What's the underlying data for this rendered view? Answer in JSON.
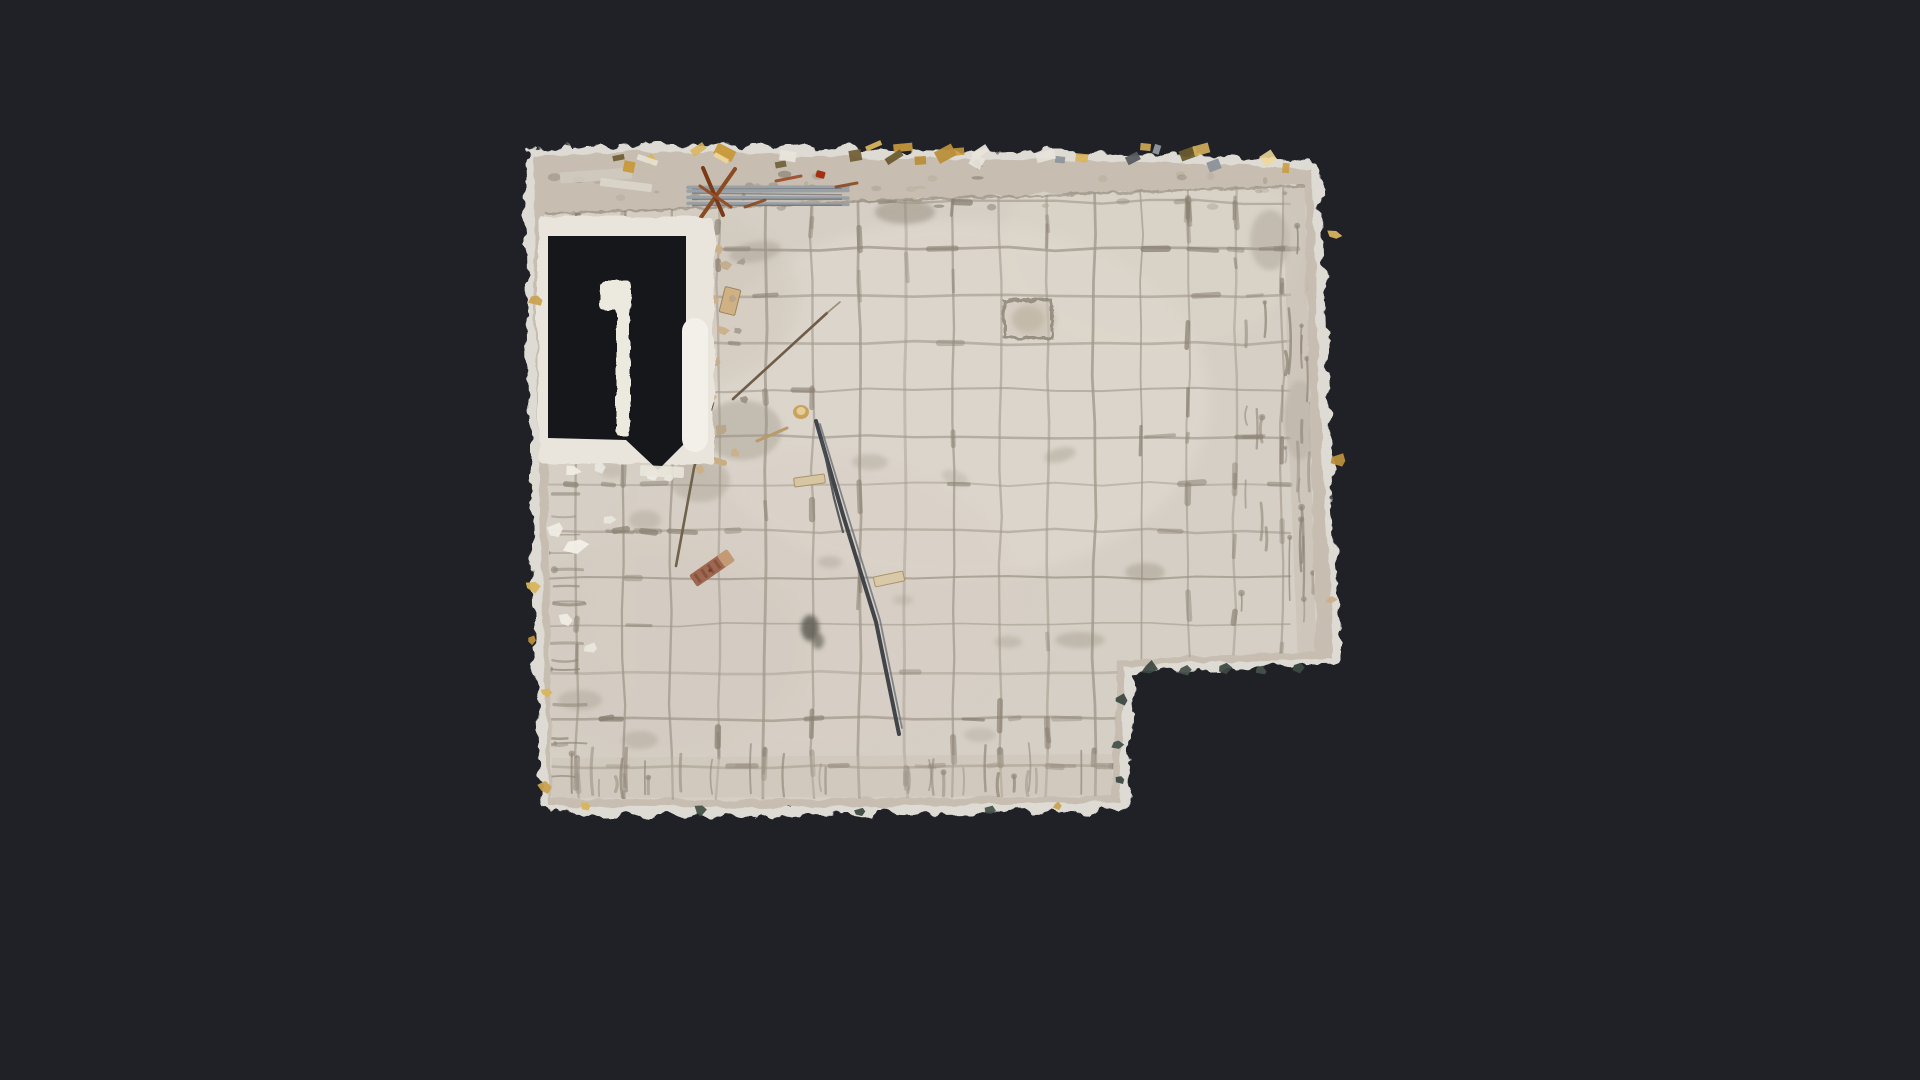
{
  "meta": {
    "view_name": "floor-plan-top-down-scan",
    "subject": "gutted room with beige tiled floor, doorway opening at top-left, notch cut-out at bottom-right, construction debris"
  },
  "scene": {
    "colors": {
      "background": "#1f2126",
      "fringe": "#e9e6df",
      "wall": "#c7beb1",
      "tile": "#d6cfc5",
      "grout": "#a1988b",
      "grout_dark": "#8a8173",
      "void": "#16171a",
      "frame": "#e9e5dc",
      "pill": "#f3f0e9",
      "pillar": "#eceade",
      "metal": "#99a0a6",
      "rod": "#41454a",
      "rust": "#8a4a22",
      "gold": "#d9b45c",
      "green_bit": "#3c4a42"
    },
    "outline": [
      [
        533,
        157
      ],
      [
        640,
        151
      ],
      [
        900,
        158
      ],
      [
        1130,
        161
      ],
      [
        1312,
        169
      ],
      [
        1319,
        400
      ],
      [
        1333,
        658
      ],
      [
        1124,
        666
      ],
      [
        1120,
        802
      ],
      [
        760,
        808
      ],
      [
        549,
        806
      ],
      [
        543,
        620
      ],
      [
        537,
        400
      ]
    ],
    "tile_poly": [
      [
        545,
        214
      ],
      [
        900,
        200
      ],
      [
        1305,
        186
      ],
      [
        1310,
        420
      ],
      [
        1316,
        652
      ],
      [
        1118,
        660
      ],
      [
        1112,
        796
      ],
      [
        700,
        800
      ],
      [
        552,
        798
      ]
    ],
    "grid": {
      "x0": 530,
      "dx": 47,
      "nx": 18,
      "y0": 202,
      "dy": 47,
      "ny": 13,
      "top": 188,
      "bottom": 802,
      "left": 538,
      "right": 1328
    },
    "door": {
      "frame": {
        "x": 538,
        "y": 216,
        "w": 176,
        "h": 248
      },
      "void_pts": [
        [
          548,
          236
        ],
        [
          686,
          236
        ],
        [
          686,
          442
        ],
        [
          658,
          470
        ],
        [
          626,
          440
        ],
        [
          548,
          438
        ]
      ],
      "pillar_cap": {
        "x": 600,
        "y": 281,
        "w": 31,
        "h": 29
      },
      "pillar_bar": {
        "x": 616,
        "y": 304,
        "w": 14,
        "h": 132
      },
      "pill": {
        "x": 682,
        "y": 318,
        "w": 26,
        "h": 134,
        "r": 13
      },
      "sill": {
        "x": 640,
        "y": 466,
        "w": 44,
        "h": 11,
        "rot": 3
      }
    },
    "right_band": [
      [
        1284,
        186
      ],
      [
        1312,
        169
      ],
      [
        1319,
        400
      ],
      [
        1333,
        658
      ],
      [
        1298,
        660
      ],
      [
        1288,
        420
      ]
    ],
    "bottom_band": [
      [
        552,
        758
      ],
      [
        1112,
        754
      ],
      [
        1112,
        796
      ],
      [
        552,
        798
      ]
    ],
    "tints": [
      {
        "x": 950,
        "y": 400,
        "rx": 260,
        "ry": 180,
        "c": "#e3dcd2",
        "o": 0.5
      },
      {
        "x": 800,
        "y": 600,
        "rx": 220,
        "ry": 150,
        "c": "#d9cfc6",
        "o": 0.4
      },
      {
        "x": 680,
        "y": 300,
        "rx": 120,
        "ry": 90,
        "c": "#cfc6b9",
        "o": 0.4
      },
      {
        "x": 1150,
        "y": 250,
        "rx": 150,
        "ry": 100,
        "c": "#ded7cb",
        "o": 0.45
      },
      {
        "x": 650,
        "y": 650,
        "rx": 160,
        "ry": 110,
        "c": "#d2c9be",
        "o": 0.4
      }
    ],
    "stains": [
      {
        "x": 755,
        "y": 252,
        "rx": 26,
        "ry": 10,
        "rot": -10,
        "c": "#9a9184",
        "o": 0.35
      },
      {
        "x": 905,
        "y": 212,
        "rx": 30,
        "ry": 12,
        "rot": 0,
        "c": "#8f8677",
        "o": 0.45
      },
      {
        "x": 1035,
        "y": 320,
        "rx": 22,
        "ry": 18,
        "rot": 0,
        "c": "#b3a996",
        "o": 0.3
      },
      {
        "x": 870,
        "y": 462,
        "rx": 18,
        "ry": 8,
        "rot": 0,
        "c": "#9a9184",
        "o": 0.3
      },
      {
        "x": 955,
        "y": 478,
        "rx": 14,
        "ry": 7,
        "rot": 20,
        "c": "#9a9184",
        "o": 0.25
      },
      {
        "x": 1145,
        "y": 572,
        "rx": 20,
        "ry": 9,
        "rot": 0,
        "c": "#8f8677",
        "o": 0.35
      },
      {
        "x": 1060,
        "y": 455,
        "rx": 16,
        "ry": 7,
        "rot": -15,
        "c": "#8f8677",
        "o": 0.3
      },
      {
        "x": 830,
        "y": 562,
        "rx": 12,
        "ry": 6,
        "rot": 0,
        "c": "#9a9184",
        "o": 0.3
      },
      {
        "x": 903,
        "y": 600,
        "rx": 10,
        "ry": 5,
        "rot": 0,
        "c": "#9a9184",
        "o": 0.25
      },
      {
        "x": 1008,
        "y": 642,
        "rx": 14,
        "ry": 6,
        "rot": 0,
        "c": "#9a9184",
        "o": 0.3
      },
      {
        "x": 742,
        "y": 430,
        "rx": 40,
        "ry": 30,
        "rot": 0,
        "c": "#97907f",
        "o": 0.35
      },
      {
        "x": 700,
        "y": 480,
        "rx": 30,
        "ry": 22,
        "rot": 0,
        "c": "#97907f",
        "o": 0.3
      },
      {
        "x": 645,
        "y": 520,
        "rx": 16,
        "ry": 10,
        "rot": 0,
        "c": "#9a9184",
        "o": 0.3
      },
      {
        "x": 612,
        "y": 470,
        "rx": 12,
        "ry": 8,
        "rot": 0,
        "c": "#a89d8c",
        "o": 0.3
      },
      {
        "x": 580,
        "y": 700,
        "rx": 22,
        "ry": 10,
        "rot": 0,
        "c": "#9a9184",
        "o": 0.3
      },
      {
        "x": 640,
        "y": 740,
        "rx": 18,
        "ry": 9,
        "rot": 0,
        "c": "#9a9184",
        "o": 0.3
      },
      {
        "x": 980,
        "y": 735,
        "rx": 16,
        "ry": 7,
        "rot": 0,
        "c": "#9a9184",
        "o": 0.25
      },
      {
        "x": 1080,
        "y": 640,
        "rx": 25,
        "ry": 8,
        "rot": 0,
        "c": "#8f8677",
        "o": 0.3
      },
      {
        "x": 1270,
        "y": 240,
        "rx": 20,
        "ry": 30,
        "rot": 0,
        "c": "#9a9184",
        "o": 0.35
      },
      {
        "x": 1300,
        "y": 420,
        "rx": 16,
        "ry": 40,
        "rot": 0,
        "c": "#9a9184",
        "o": 0.4
      },
      {
        "x": 810,
        "y": 628,
        "rx": 9,
        "ry": 13,
        "rot": 0,
        "c": "#5f5d55",
        "o": 0.85
      },
      {
        "x": 818,
        "y": 641,
        "rx": 6,
        "ry": 8,
        "rot": 0,
        "c": "#6b685e",
        "o": 0.7
      }
    ],
    "emphasis_zones": [
      {
        "x": 545,
        "y": 192,
        "w": 770,
        "h": 70,
        "n": 30
      },
      {
        "x": 560,
        "y": 690,
        "w": 556,
        "h": 104,
        "n": 34
      },
      {
        "x": 1150,
        "y": 190,
        "w": 166,
        "h": 462,
        "n": 26
      },
      {
        "x": 545,
        "y": 450,
        "w": 130,
        "h": 348,
        "n": 18
      },
      {
        "x": 700,
        "y": 250,
        "w": 600,
        "h": 430,
        "n": 22
      }
    ],
    "drip_clusters": [
      {
        "kind": "down",
        "x0": 1288,
        "x1": 1326,
        "y0": 200,
        "y1": 600,
        "n": 24,
        "l0": 18,
        "l1": 70,
        "c": "#8b8275"
      },
      {
        "kind": "down",
        "x0": 1240,
        "x1": 1286,
        "y0": 300,
        "y1": 600,
        "n": 12,
        "l0": 12,
        "l1": 40,
        "c": "#8f8678"
      },
      {
        "kind": "up",
        "x0": 565,
        "x1": 1110,
        "y0": 790,
        "y1": 798,
        "n": 26,
        "l0": 14,
        "l1": 52,
        "c": "#8f8677"
      },
      {
        "kind": "right",
        "x0": 548,
        "x1": 556,
        "y0": 470,
        "y1": 795,
        "n": 16,
        "l0": 10,
        "l1": 34,
        "c": "#8f8677"
      }
    ],
    "top_mottle": {
      "x0": 552,
      "x1": 1300,
      "y0": 174,
      "y1": 208,
      "n": 46
    },
    "gold_top": {
      "x0": 545,
      "x1": 1305,
      "y0": 142,
      "y1": 164,
      "n": 30,
      "palette": [
        "#d9b45c",
        "#c89a3e",
        "#efd79a",
        "#8f959c",
        "#565b60",
        "#e8e4da",
        "#b98f3a",
        "#6b5a2e"
      ]
    },
    "items": [
      {
        "t": "rect",
        "x": 560,
        "y": 170,
        "w": 72,
        "h": 11,
        "rot": -4,
        "c": "#cfc9be",
        "o": 0.9
      },
      {
        "t": "rect",
        "x": 600,
        "y": 181,
        "w": 52,
        "h": 8,
        "rot": 7,
        "c": "#ddd8cd",
        "o": 0.85
      },
      {
        "t": "pipes",
        "x": 688,
        "y": 186,
        "len": 160,
        "n": 4,
        "gap": 6,
        "c": "#99a0a6",
        "c2": "#5f646a"
      },
      {
        "t": "line",
        "x1": 690,
        "y1": 233,
        "x2": 735,
        "y2": 169,
        "w": 4,
        "c": "#8a4a22",
        "o": 1
      },
      {
        "t": "line",
        "x1": 703,
        "y1": 168,
        "x2": 723,
        "y2": 215,
        "w": 4,
        "c": "#7a3a18",
        "o": 1
      },
      {
        "t": "line",
        "x1": 700,
        "y1": 186,
        "x2": 731,
        "y2": 207,
        "w": 3,
        "c": "#93502a",
        "o": 1
      },
      {
        "t": "line",
        "x1": 745,
        "y1": 207,
        "x2": 765,
        "y2": 200,
        "w": 3,
        "c": "#8a4a22",
        "o": 0.9
      },
      {
        "t": "line",
        "x1": 776,
        "y1": 181,
        "x2": 801,
        "y2": 176,
        "w": 3,
        "c": "#9c4a26",
        "o": 0.9
      },
      {
        "t": "line",
        "x1": 836,
        "y1": 187,
        "x2": 857,
        "y2": 183,
        "w": 3,
        "c": "#8a4a22",
        "o": 0.9
      },
      {
        "t": "rect",
        "x": 816,
        "y": 171,
        "w": 9,
        "h": 7,
        "rot": 15,
        "c": "#a33012",
        "o": 1
      },
      {
        "t": "path",
        "pts": [
          [
            816,
            421
          ],
          [
            843,
            515
          ],
          [
            876,
            622
          ],
          [
            899,
            734
          ]
        ],
        "w": 4,
        "c": "#41454a",
        "o": 1
      },
      {
        "t": "path",
        "pts": [
          [
            820,
            424
          ],
          [
            848,
            516
          ],
          [
            880,
            620
          ],
          [
            902,
            728
          ]
        ],
        "w": 1.8,
        "c": "#767b81",
        "o": 0.9
      },
      {
        "t": "path",
        "pts": [
          [
            822,
            440
          ],
          [
            834,
            498
          ],
          [
            843,
            532
          ]
        ],
        "w": 2.2,
        "c": "#4a4e52",
        "o": 0.9
      },
      {
        "t": "line",
        "x1": 733,
        "y1": 399,
        "x2": 827,
        "y2": 313,
        "w": 2.6,
        "c": "#6e5d48",
        "o": 1
      },
      {
        "t": "line",
        "x1": 827,
        "y1": 313,
        "x2": 840,
        "y2": 302,
        "w": 1.6,
        "c": "#8a7a60",
        "o": 0.8
      },
      {
        "t": "path",
        "pts": [
          [
            713,
            403
          ],
          [
            694,
            468
          ],
          [
            676,
            566
          ]
        ],
        "w": 2.6,
        "c": "#71624c",
        "o": 1
      },
      {
        "t": "line",
        "x1": 757,
        "y1": 441,
        "x2": 787,
        "y2": 428,
        "w": 3,
        "c": "#b99a6a",
        "o": 1
      },
      {
        "t": "line",
        "x1": 700,
        "y1": 456,
        "x2": 724,
        "y2": 463,
        "w": 6,
        "c": "#c9ae82",
        "o": 1
      },
      {
        "t": "rect",
        "x": 722,
        "y": 288,
        "w": 16,
        "h": 26,
        "rot": 14,
        "c": "#cfb184",
        "o": 1,
        "s": "#9a855e",
        "sw": 1
      },
      {
        "t": "brush",
        "x": 712,
        "y": 568,
        "w": 46,
        "h": 14,
        "rot": -35
      },
      {
        "t": "ell",
        "x": 801,
        "y": 412,
        "rx": 8,
        "ry": 7,
        "c": "#c9a25f",
        "o": 1
      },
      {
        "t": "ell",
        "x": 801,
        "y": 411,
        "rx": 4.5,
        "ry": 4,
        "c": "#e6cd96",
        "o": 1
      },
      {
        "t": "rect",
        "x": 794,
        "y": 476,
        "w": 31,
        "h": 9,
        "rot": -8,
        "c": "#d7c6a4",
        "o": 1,
        "s": "#a89468",
        "sw": 1
      },
      {
        "t": "rect",
        "x": 874,
        "y": 574,
        "w": 30,
        "h": 10,
        "rot": -12,
        "c": "#d9c9a8",
        "o": 1,
        "s": "#a89468",
        "sw": 1
      },
      {
        "t": "sqout",
        "x": 1004,
        "y": 300,
        "w": 48,
        "h": 38
      }
    ],
    "chips": [
      {
        "x": 718,
        "y": 248,
        "s": 8,
        "c": "#cbb089"
      },
      {
        "x": 726,
        "y": 266,
        "s": 7,
        "c": "#c2ad8c"
      },
      {
        "x": 714,
        "y": 300,
        "s": 9,
        "c": "#cbb089"
      },
      {
        "x": 733,
        "y": 299,
        "s": 6,
        "c": "#b7a588"
      },
      {
        "x": 722,
        "y": 330,
        "s": 7,
        "c": "#cbb089"
      },
      {
        "x": 716,
        "y": 362,
        "s": 8,
        "c": "#c2ad8c"
      },
      {
        "x": 710,
        "y": 396,
        "s": 7,
        "c": "#cbb089"
      },
      {
        "x": 722,
        "y": 430,
        "s": 8,
        "c": "#b7a588"
      },
      {
        "x": 735,
        "y": 452,
        "s": 7,
        "c": "#cbb089"
      },
      {
        "x": 700,
        "y": 470,
        "s": 6,
        "c": "#cbb089"
      },
      {
        "x": 742,
        "y": 262,
        "s": 6,
        "c": "#a89d8e"
      },
      {
        "x": 738,
        "y": 330,
        "s": 5,
        "c": "#a89d8e"
      },
      {
        "x": 744,
        "y": 400,
        "s": 6,
        "c": "#9a9184"
      },
      {
        "x": 560,
        "y": 456,
        "s": 13,
        "c": "#efece4"
      },
      {
        "x": 572,
        "y": 470,
        "s": 9,
        "c": "#efece4"
      },
      {
        "x": 600,
        "y": 468,
        "s": 8,
        "c": "#e9e6de"
      },
      {
        "x": 556,
        "y": 530,
        "s": 11,
        "c": "#efece4"
      },
      {
        "x": 576,
        "y": 546,
        "s": 15,
        "c": "#f2efe8"
      },
      {
        "x": 566,
        "y": 620,
        "s": 9,
        "c": "#efece4"
      },
      {
        "x": 590,
        "y": 648,
        "s": 8,
        "c": "#e9e6de"
      },
      {
        "x": 610,
        "y": 520,
        "s": 7,
        "c": "#e9e6de"
      },
      {
        "x": 652,
        "y": 474,
        "s": 9,
        "c": "#efece4"
      },
      {
        "x": 668,
        "y": 478,
        "s": 7,
        "c": "#e9e6de"
      },
      {
        "x": 700,
        "y": 228,
        "s": 7,
        "c": "#e9e6de"
      }
    ],
    "edge_bits": [
      {
        "x": 536,
        "y": 300,
        "s": 8,
        "c": "#c9a24e"
      },
      {
        "x": 534,
        "y": 586,
        "s": 9,
        "c": "#d9b45c"
      },
      {
        "x": 531,
        "y": 640,
        "s": 6,
        "c": "#b98f3a"
      },
      {
        "x": 547,
        "y": 692,
        "s": 7,
        "c": "#d9b45c"
      },
      {
        "x": 545,
        "y": 788,
        "s": 8,
        "c": "#c9a24e"
      },
      {
        "x": 586,
        "y": 806,
        "s": 7,
        "c": "#d9b45c"
      },
      {
        "x": 1058,
        "y": 806,
        "s": 6,
        "c": "#c9a24e"
      },
      {
        "x": 1334,
        "y": 235,
        "s": 8,
        "c": "#d9b45c"
      },
      {
        "x": 1339,
        "y": 460,
        "s": 9,
        "c": "#b98f3a"
      },
      {
        "x": 1331,
        "y": 600,
        "s": 7,
        "c": "#cbb089"
      },
      {
        "x": 1150,
        "y": 668,
        "s": 9,
        "c": "#3c4a42"
      },
      {
        "x": 1185,
        "y": 670,
        "s": 7,
        "c": "#45524a"
      },
      {
        "x": 1225,
        "y": 668,
        "s": 8,
        "c": "#3c4a42"
      },
      {
        "x": 1262,
        "y": 671,
        "s": 6,
        "c": "#45524a"
      },
      {
        "x": 1298,
        "y": 668,
        "s": 8,
        "c": "#3c4a42"
      },
      {
        "x": 1120,
        "y": 700,
        "s": 8,
        "c": "#3c4a42"
      },
      {
        "x": 1118,
        "y": 745,
        "s": 7,
        "c": "#45524a"
      },
      {
        "x": 1121,
        "y": 780,
        "s": 6,
        "c": "#3c4a42"
      },
      {
        "x": 700,
        "y": 810,
        "s": 8,
        "c": "#45524a"
      },
      {
        "x": 860,
        "y": 812,
        "s": 7,
        "c": "#3c4a42"
      },
      {
        "x": 990,
        "y": 810,
        "s": 6,
        "c": "#45524a"
      }
    ]
  }
}
